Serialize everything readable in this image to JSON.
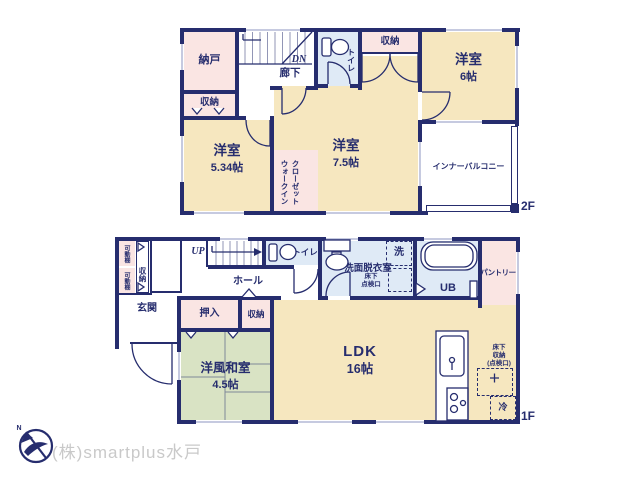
{
  "colors": {
    "wall": "#262d6e",
    "cream": "#f6e7bf",
    "pink": "#fae5e3",
    "blue": "#dfeaf6",
    "green": "#d9e3c4",
    "window_line": "#8d96c2",
    "watermark": "#c9c9c9"
  },
  "floor2": {
    "floor_label": "2F",
    "nando": "納戸",
    "closet_left": "収納",
    "stair_direction": "DN",
    "hallway": "廊下",
    "toilet": "トイレ",
    "closet_top": "収納",
    "room6": {
      "name": "洋室",
      "size": "6帖"
    },
    "room534": {
      "name": "洋室",
      "size": "5.34帖"
    },
    "room75": {
      "name": "洋室",
      "size": "7.5帖"
    },
    "wic": "ウォークイン\nクローゼット",
    "balcony": "インナーバルコニー"
  },
  "floor1": {
    "floor_label": "1F",
    "movable_shelf": "可動棚",
    "shoe_closet": "収納",
    "entrance": "玄関",
    "stair_direction": "UP",
    "hall": "ホール",
    "toilet": "トイレ",
    "ps": "PS",
    "washroom": "洗面脱衣室",
    "washer": "洗",
    "underfloor_hatch": "床下\n点検口",
    "bath": "UB",
    "pantry": "パントリー",
    "oshiire": "押入",
    "closet": "収納",
    "washitsu": {
      "name": "洋風和室",
      "size": "4.5帖"
    },
    "ldk": {
      "name": "LDK",
      "size": "16帖"
    },
    "underfloor_storage": "床下\n収納\n(点検口)",
    "fridge": "冷"
  },
  "compass": {
    "north": "N"
  },
  "watermark": {
    "text": "(株)smartplus水戸"
  }
}
